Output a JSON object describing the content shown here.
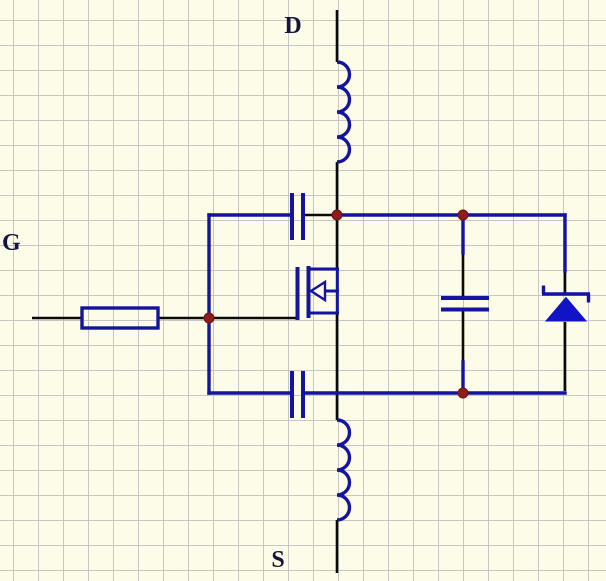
{
  "window": {
    "width": 606,
    "height": 581
  },
  "colors": {
    "bg": "#fcfce9",
    "grid": "#c6c6c6",
    "wire": "#0a0a0a",
    "navy": "#14149e",
    "diode_fill": "#1313c6",
    "dot": "#8e1c1c",
    "label": "#14143c"
  },
  "schematic": {
    "kind": "mosfet-circuit-schematic",
    "terminals": {
      "drain": "D",
      "gate": "G",
      "source": "S"
    },
    "components": [
      {
        "id": "inductor-top",
        "type": "inductor"
      },
      {
        "id": "inductor-bottom",
        "type": "inductor"
      },
      {
        "id": "resistor-gate",
        "type": "resistor"
      },
      {
        "id": "capacitor-gate-drain",
        "type": "capacitor"
      },
      {
        "id": "capacitor-gate-source",
        "type": "capacitor"
      },
      {
        "id": "capacitor-drain-source",
        "type": "capacitor"
      },
      {
        "id": "diode-body",
        "type": "zener-diode"
      },
      {
        "id": "mosfet",
        "type": "n-channel-mosfet"
      }
    ],
    "junction_dot_count": 4
  }
}
